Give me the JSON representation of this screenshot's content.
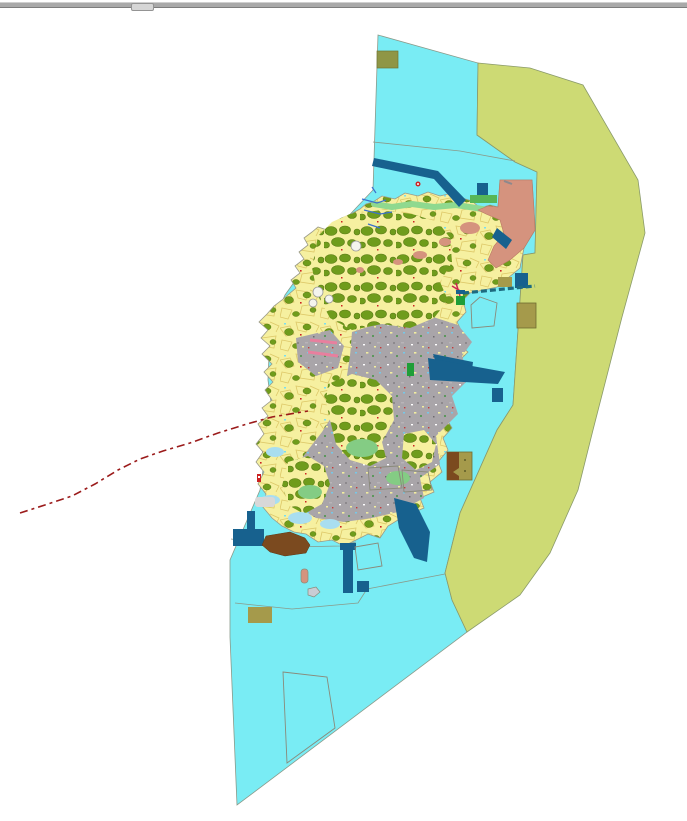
{
  "window": {
    "top_bar": {
      "kind": "divider-bar",
      "has_drag_handle": true
    }
  },
  "map": {
    "kind": "land-use-gis-map",
    "features": [
      {
        "name": "coastal-water-zone",
        "color_key": "water"
      },
      {
        "name": "eastern-buffer-zone",
        "color_key": "buffer"
      },
      {
        "name": "island-parcel-mosaic",
        "color_key": "island_base"
      },
      {
        "name": "forest-orchard-areas",
        "color_key": "forest"
      },
      {
        "name": "urban-built-up-area",
        "color_key": "urban"
      },
      {
        "name": "north-parcel-grid",
        "color_key": "grid_bg"
      },
      {
        "name": "northeast-district",
        "color_key": "salmon"
      },
      {
        "name": "north-coastal-green-strip",
        "color_key": "coastal_green"
      },
      {
        "name": "harbor-breakwater-structures",
        "color_key": "dark_blue"
      },
      {
        "name": "ferry-jetty-dashed",
        "color_key": "jetty"
      },
      {
        "name": "brown-coastal-site",
        "color_key": "brown"
      },
      {
        "name": "khaki-survey-parcels",
        "color_key": "khaki"
      },
      {
        "name": "planned-area-outlines",
        "color_key": "outline"
      },
      {
        "name": "administrative-dashed-boundary",
        "color_key": "red_line"
      },
      {
        "name": "streams",
        "color_key": "stream"
      },
      {
        "name": "pink-piers",
        "color_key": "pink"
      },
      {
        "name": "small-islets",
        "color_key": "islet_gray"
      }
    ]
  },
  "colors": {
    "water": "#79ecf4",
    "buffer": "#cdda74",
    "island_base": "#f6f0a0",
    "parcel_line": "#ddc868",
    "forest": "#6f9c1c",
    "forest_edge": "#55770f",
    "coastal_green": "#8fd98f",
    "medium_green": "#57b657",
    "bright_green": "#1f9e38",
    "urban": "#a9a5a9",
    "grid_bg": "#cfc9bb",
    "salmon": "#d5937e",
    "salmon_edge": "#b97a62",
    "dark_blue": "#17618e",
    "brown": "#7b4a1f",
    "khaki": "#a59a4b",
    "olive_khaki": "#8f9646",
    "khaki_outline": "#6f6b30",
    "lagoon": "#a9def0",
    "light_gray": "#d8d8d8",
    "red_line": "#9b1b1b",
    "pink": "#e87f9e",
    "stream": "#3a70cc",
    "jetty": "#1d6b80",
    "outline": "#8a8a7a",
    "islet_gray": "#c9ccd4",
    "white_fill": "#f4f4ee"
  }
}
